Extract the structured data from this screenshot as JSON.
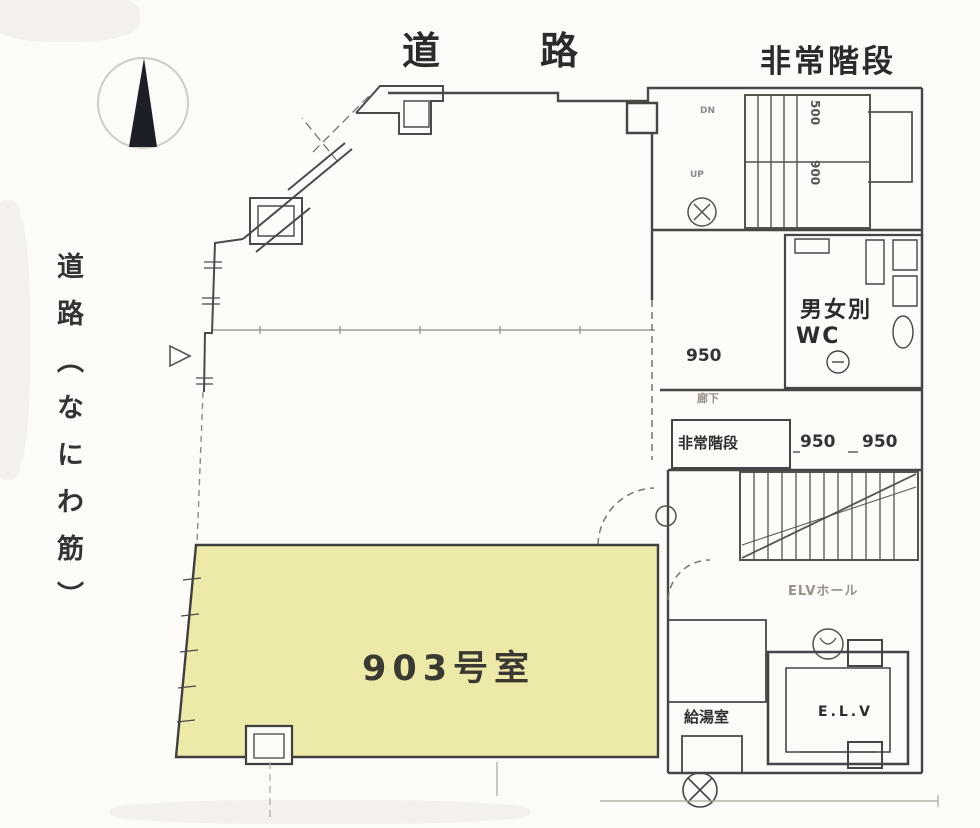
{
  "document": {
    "type": "scanned-floor-plan"
  },
  "labels": {
    "road_top_a": "道",
    "road_top_b": "路",
    "road_left": "道路（なにわ筋）",
    "emergency_stairs": "非常階段",
    "room_903": "903号室",
    "wc_line1": "男女別",
    "wc_line2": "WC",
    "stairwell": "非常階段",
    "corridor": "廊下",
    "elv_hall": "ELVホール",
    "elevator": "E.L.V",
    "pantry": "給湯室",
    "stair_up": "UP",
    "stair_dn": "DN"
  },
  "dimensions": {
    "corridor_950": "950",
    "landing_950_a": "950",
    "landing_950_b": "950",
    "upper_stair_500": "500",
    "upper_stair_900": "900"
  },
  "icons": {
    "north_arrow": "compass-north-needle",
    "equipment_circle": "mechanical-symbol",
    "manhole": "hatched-circle-symbol"
  },
  "colors": {
    "room_highlight": "#EDE9A9",
    "wall": "#454545",
    "needle": "#1c2026",
    "faint_line": "#a8a49e"
  }
}
